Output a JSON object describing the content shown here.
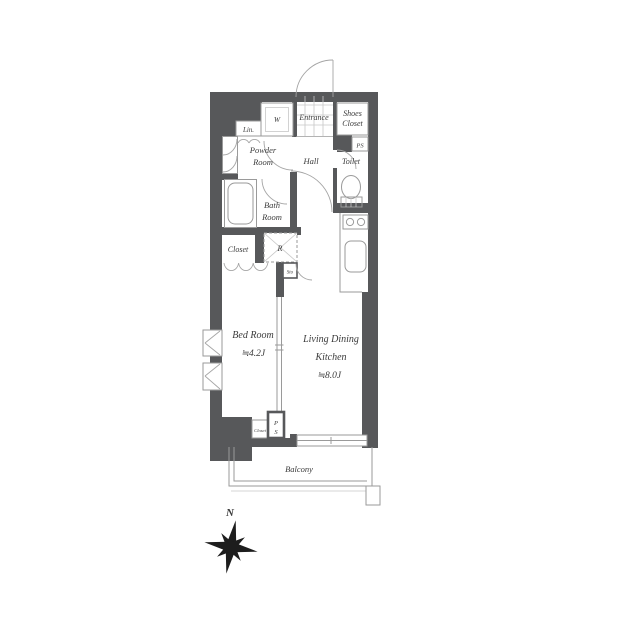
{
  "floorplan": {
    "labels": {
      "entrance": "Entrance",
      "shoes_closet_1": "Shoes",
      "shoes_closet_2": "Closet",
      "ps_upper": "PS",
      "hall": "Hall",
      "toilet": "Toilet",
      "lin": "Lin.",
      "washer": "W",
      "powder_1": "Powder",
      "powder_2": "Room",
      "bath_1": "Bath",
      "bath_2": "Room",
      "closet": "Closet",
      "fridge": "R",
      "storage": "Sto",
      "bedroom_1": "Bed Room",
      "bedroom_2": "≒4.2J",
      "ldk_1": "Living Dining",
      "ldk_2": "Kitchen",
      "ldk_3": "≒8.0J",
      "closet_small": "Closet",
      "ps_lower_1": "P",
      "ps_lower_2": "S",
      "balcony": "Balcony",
      "compass_north": "N"
    },
    "colors": {
      "wall": "#57585a",
      "fixture_line": "#9a9a9a",
      "text": "#3b3b3b"
    }
  }
}
